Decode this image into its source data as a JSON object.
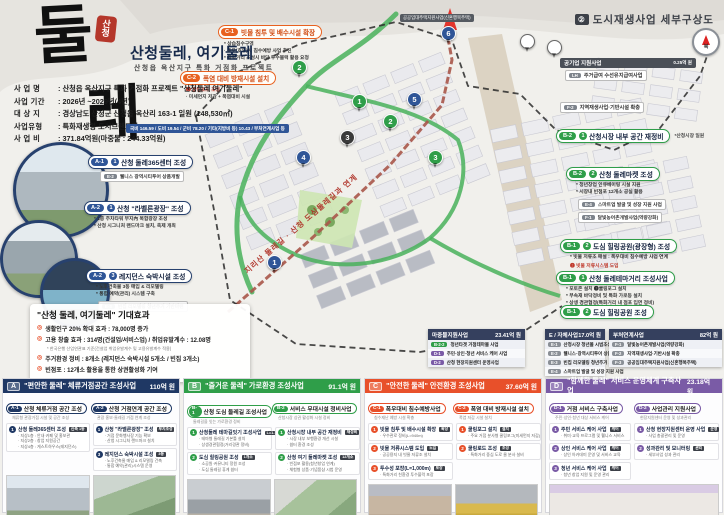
{
  "header": {
    "logo_char1": "둘",
    "logo_char2": "레",
    "stamp_line1": "산",
    "stamp_line2": "청",
    "title": "산청둘레, 여기둘레",
    "subtitle": "산청읍 옥산지구 특화 거점화 프로젝트"
  },
  "project_info": {
    "rows": [
      {
        "label": "사 업 명",
        "value": "산청읍 옥산지구 특화 거점화 프로젝트 \"산청둘레 여기둘레\""
      },
      {
        "label": "사업 기간",
        "value": "2026년 ~2029년(4년)"
      },
      {
        "label": "대 상 지",
        "value": "경상남도 산청군 산청읍 옥산리 163-1 일원 (148,530㎡)"
      },
      {
        "label": "사업유형",
        "value": "특화재생형 도시브랜드화"
      },
      {
        "label": "사 업 비",
        "value": "371.84억원(마중물 : 244.33억원)"
      }
    ],
    "funding_bar": "국비 146.59 / 도비 19.54 / 군비 78.20 / 기타(지방비 등) 10.43 / 부처연계사업 등"
  },
  "left_callouts": [
    {
      "code": "A-1",
      "num": "①",
      "title": "산청 둘레365센터 조성",
      "bullets": [],
      "boxes": [
        {
          "code": "E-2",
          "text": "웰니스 광역시티투어 상품개발"
        }
      ],
      "x": 88,
      "y": 150
    },
    {
      "code": "A-2",
      "num": "①",
      "title": "산청 \"라벨른광장\" 조성",
      "bullets": [
        "* 1층 주차타워 부지內 복합광장 조성",
        "* 산청 시그니처 랜드마크 설치, 축제 개최"
      ],
      "boxes": [],
      "x": 84,
      "y": 196
    },
    {
      "code": "A-2",
      "num": "❸",
      "title": "레지던스 숙박시설 조성",
      "bullets": [
        "* 노후건축물 3동 매입 & 리모델링",
        "* 통합 예약(관리) 시스템 구축"
      ],
      "boxes": [
        {
          "code": "E-3",
          "text": "빈집 리모델링 청년주거 기반마련"
        }
      ],
      "x": 86,
      "y": 264
    }
  ],
  "effects": {
    "title": "\"산청 둘레, 여기둘레\" 기대효과",
    "items": [
      "생활인구 20% 확대 효과 : 78,000명 증가",
      "고용 창출 효과 : 314명(건설업/서비스업) / 취업유발계수 : 12.08명",
      "주거환경 정비 : 8개소 (레지던스 숙박시설 5개소 / 빈집 3개소)",
      "빈점포 : 12개소 활용을 통한 상권활성화 기여"
    ],
    "footnote": "* 한국은행 산업연관표 기준(건설업 취업유발계수 및 고용유발계수 적용)"
  },
  "map": {
    "title_num": "②",
    "title": "도시재생사업 세부구상도",
    "compass_label": "북",
    "corridor_label": "지리산 둘레길 · 산청 도심둘레길과 연계",
    "arrow_label": "공공임대주택지원사업(신혼행복주택)",
    "callout_c1": {
      "code": "C-1",
      "title": "빗물 침투 및 배수시설 확장",
      "bullets": [
        "* 상습침수구역",
        "· 폭우(호우)시 침수예방 사업 추진",
        "* 특화거리 조성시 바닥 투수블럭 활용 요청"
      ]
    },
    "callout_c2": {
      "code": "C-2",
      "title": "폭염 대비 방재시설 설치",
      "bullets": [
        "❷ 쿨링로드 조성",
        "· 미세먼지 저감 + 폭염대비 시설"
      ]
    },
    "public_support": {
      "title": "공기업 지원사업",
      "amount": "0.25억 원",
      "row_code": "LH",
      "row_text": "주거급여 수선유지급여사업"
    },
    "f2_box": {
      "code": "F-2",
      "text": "지역재생사업·기반시설 확충"
    },
    "right_callouts": [
      {
        "code": "B-2",
        "num": "①",
        "title": "산청시장 내부 공간 재정비",
        "side": "*산청시장 일원",
        "bullets": [],
        "boxes": [],
        "red": "",
        "x": 556,
        "y": 124
      },
      {
        "code": "B-2",
        "num": "②",
        "title": "산청 둘레마켓 조성",
        "side": "",
        "bullets": [
          "* 청년창업 인큐베이팅 시설 지원",
          "* 시장내 빈점포 12개소 공실 활용"
        ],
        "boxes": [
          {
            "code": "E-4",
            "text": "스마트업 발굴 및 성장 지원 사업"
          },
          {
            "code": "F-1",
            "text": "달빛농어촌개발사업(역량강화)"
          }
        ],
        "red": "",
        "x": 566,
        "y": 162
      },
      {
        "code": "B-1",
        "num": "②",
        "title": "도심 힐링공원(광장형) 조성",
        "side": "",
        "bullets": [
          "* 빗물 저류조 매설 : 폭우대비 침수예방 사업 연계"
        ],
        "boxes": [],
        "red": "❷ 빗물 저류시스템 도입",
        "x": 560,
        "y": 234
      },
      {
        "code": "B-1",
        "num": "①",
        "title": "산청 둘레테마거리 조성사업",
        "side": "",
        "bullets": [
          "* 포토존 설치  ❶쿨링포그 설치",
          "* 부속재 바닥정비 및 특화 가로등 설치",
          "* 상생 경관협정(특화거리 내 점포 입면 정비)"
        ],
        "boxes": [],
        "red": "",
        "x": 556,
        "y": 266
      },
      {
        "code": "B-1",
        "num": "②",
        "title": "도심 힐링공원 조성",
        "side": "",
        "bullets": [],
        "boxes": [],
        "red": "",
        "x": 560,
        "y": 300
      }
    ],
    "pins": [
      {
        "n": "6",
        "c": "#2f5597",
        "x": 441,
        "y": 26
      },
      {
        "n": "2",
        "c": "#2f9e49",
        "x": 292,
        "y": 60
      },
      {
        "n": "1",
        "c": "#2f9e49",
        "x": 352,
        "y": 94
      },
      {
        "n": "5",
        "c": "#2f5597",
        "x": 407,
        "y": 92
      },
      {
        "n": "2",
        "c": "#2f9e49",
        "x": 383,
        "y": 114
      },
      {
        "n": "3",
        "c": "#3a3a3a",
        "x": 340,
        "y": 130
      },
      {
        "n": "4",
        "c": "#2f5597",
        "x": 296,
        "y": 150
      },
      {
        "n": "3",
        "c": "#2f9e49",
        "x": 428,
        "y": 150
      },
      {
        "n": "1",
        "c": "#2f5597",
        "x": 267,
        "y": 255
      },
      {
        "n": "",
        "c": "#ffffff",
        "x": 520,
        "y": 34
      },
      {
        "n": "",
        "c": "#ffffff",
        "x": 547,
        "y": 40
      }
    ]
  },
  "fund_tables": [
    {
      "title": "마중물지원사업",
      "amount": "23.41억 원",
      "x": 428,
      "y": 329,
      "w": 97,
      "rows": [
        {
          "code": "B-2-2",
          "color": "green",
          "text": "청년타겟 거점테마몰 사업"
        },
        {
          "code": "D-1",
          "color": "purple",
          "text": "주민·상인·청년 서비스 케어 사업"
        },
        {
          "code": "D-2",
          "color": "purple",
          "text": "산청 현장지원센터 운영사업"
        }
      ]
    },
    {
      "title": "E / 자체사업",
      "amount": "17.0억 원",
      "x": 545,
      "y": 329,
      "w": 60,
      "rows": [
        {
          "code": "E-1",
          "color": "gray",
          "text": "산청시장 청년몰 시범조성사업"
        },
        {
          "code": "E-2",
          "color": "gray",
          "text": "웰니스·광역시티투어 상품개발"
        },
        {
          "code": "E-3",
          "color": "gray",
          "text": "빈집 리모델링 청년주거 기반마련"
        },
        {
          "code": "E-4",
          "color": "gray",
          "text": "스마트업 발굴 및 성장 지원 사업"
        }
      ]
    },
    {
      "title": "부처연계사업",
      "amount": "82억 원",
      "x": 609,
      "y": 329,
      "w": 113,
      "rows": [
        {
          "code": "F-1",
          "color": "gray",
          "text": "달빛농어촌개발사업(역량강화)"
        },
        {
          "code": "F-2",
          "color": "gray",
          "text": "지역재생사업·기반시설 확충"
        },
        {
          "code": "F-3",
          "color": "gray",
          "text": "공공임대주택지원사업(신혼행복주택)"
        }
      ]
    }
  ],
  "panels": [
    {
      "letter": "A",
      "color": "#1f3864",
      "title": "\"편안한 둘레\" 체류거점공간 조성사업",
      "amount": "110억 원",
      "x": 2,
      "groups": [
        {
          "code": "A-1",
          "title": "산청 체류거점 공간 조성",
          "note": "체류형 관광거점 시설 및 공간 조성"
        },
        {
          "code": "A-2",
          "title": "산청 거점연계 공간 조성",
          "note": "관광 홍보·둘레길 거점 연계 조성"
        }
      ],
      "items": [
        {
          "col": 0,
          "num": "①",
          "title": "산청 둘레365센터 조성",
          "tag": "신축 1동",
          "bullets": [
            "· 지상1층 : 안내·카페 및 홍보관",
            "· 지상2층 : 창업 지원공간",
            "· 지상4층 : 게스트하우스(레지던스)"
          ]
        },
        {
          "col": 1,
          "num": "①",
          "title": "산청 \"라벨른광장\" 조성",
          "tag": "부지조성",
          "bullets": [
            "· 거점 문화행사장 기능 확보",
            "· 산청 시그니처 랜드마크 설치"
          ]
        },
        {
          "col": 1,
          "num": "❸",
          "title": "레지던스 숙박시설 조성",
          "tag": "3동",
          "bullets": [
            "· 노후건축물 매입 & 리모델링 건축",
            "· 통합 예약(관리)시스템 운영"
          ]
        }
      ],
      "photos": [
        "ph-a1",
        "ph-a2"
      ]
    },
    {
      "letter": "B",
      "color": "#2f9e49",
      "title": "\"즐거운 둘레\" 가로환경 조성사업",
      "amount": "91.1억 원",
      "x": 183,
      "groups": [
        {
          "code": "B-1",
          "title": "산청 도심 둘레길 조성사업",
          "note": "둘레길을 잇는 가로환경 정비"
        },
        {
          "code": "B-2",
          "title": "서비스 무대시설 정비사업",
          "note": "산청시장 상권 활성화 시설 정비"
        }
      ],
      "items": [
        {
          "col": 0,
          "num": "①",
          "title": "산청둘레 테마길잇기 조성사업",
          "tag": "L=1.1km",
          "bullets": [
            "· 테마형 둘레길 기본틀 설치",
            "· 상생경관협정(거리경관 정비)"
          ]
        },
        {
          "col": 0,
          "num": "②",
          "title": "도심 힐링공원 조성",
          "tag": "1개소",
          "bullets": [
            "· 소공원·커뮤니티 정원 조성",
            "· 도심 둘레길 휴게 쉼터"
          ]
        },
        {
          "col": 1,
          "num": "①",
          "title": "산청시장 내부 공간 재정비",
          "tag": "재정비",
          "bullets": [
            "· 시장 내부 보행환경 개선 시설",
            "· 쉼터 환경 조성"
          ]
        },
        {
          "col": 1,
          "num": "②",
          "title": "산청 여기 둘레마켓 조성",
          "tag": "12개소",
          "bullets": [
            "· 빈점포 활용(청년창업 연계)",
            "· 체험형 상품·기념품샵 시범 운영"
          ]
        }
      ],
      "photos": [
        "ph-b1",
        "ph-b2"
      ]
    },
    {
      "letter": "C",
      "color": "#e8502a",
      "title": "\"안전한 둘레\" 안전환경 조성사업",
      "amount": "37.60억 원",
      "x": 364,
      "groups": [
        {
          "code": "C-1",
          "title": "폭우대비 침수예방사업",
          "note": "침수재난 예방 시설 확충"
        },
        {
          "code": "C-2",
          "title": "폭염 대비 방재시설 설치",
          "note": "폭염 저감 시설 설치"
        }
      ],
      "items": [
        {
          "col": 0,
          "num": "①",
          "title": "빗물 침투 및 배수시설 확장",
          "tag": "확장",
          "bullets": [
            "· 우수관로 정비(L=940m)"
          ]
        },
        {
          "col": 0,
          "num": "②",
          "title": "빗물 저류시스템 도입",
          "tag": "도입",
          "bullets": [
            "· 공공용지 내 빗물 저류조 설치"
          ]
        },
        {
          "col": 0,
          "num": "③",
          "title": "투수성 포장(L=1,000m)",
          "tag": "포장",
          "bullets": [
            "· 특화거리 친환경 투수블럭 포장"
          ]
        },
        {
          "col": 1,
          "num": "①",
          "title": "쿨링포그 설치",
          "tag": "설치",
          "bullets": [
            "· 주요 거점 분사형 쿨링포그(미세먼지 저감)"
          ]
        },
        {
          "col": 1,
          "num": "②",
          "title": "쿨링로드 조성",
          "tag": "조성",
          "bullets": [
            "· 특화거리 중심 도로 물 분사 설비"
          ]
        }
      ],
      "photos": [
        "ph-c1",
        "ph-c2"
      ]
    },
    {
      "letter": "D",
      "color": "#7a5ba6",
      "title": "\"함께한 둘레\" 서비스 운영체계 구축사업",
      "amount": "23.18억 원",
      "x": 545,
      "groups": [
        {
          "code": "D-1",
          "title": "거점 서비스 구축사업",
          "note": "주민·상인·청년 대상 서비스 케어"
        },
        {
          "code": "D-2",
          "title": "사업관리 지원사업",
          "note": "현장지원센터 운영 및 성과관리"
        }
      ],
      "items": [
        {
          "col": 0,
          "num": "①",
          "title": "주민 서비스 케어 사업",
          "tag": "케어",
          "bullets": [
            "· 취미·교육 프로그램 및 웰니스 서비스"
          ]
        },
        {
          "col": 0,
          "num": "②",
          "title": "상인 서비스 케어 사업",
          "tag": "케어",
          "bullets": [
            "· 상인 아카데미 운영 및 서비스 교육"
          ]
        },
        {
          "col": 0,
          "num": "③",
          "title": "청년 서비스 케어 사업",
          "tag": "케어",
          "bullets": [
            "· 청년 창업 지원 및 운영 관리"
          ]
        },
        {
          "col": 1,
          "num": "①",
          "title": "산청 현장지원센터 운영 사업",
          "tag": "운영",
          "bullets": [
            "· 사업 총괄관리 및 운영"
          ]
        },
        {
          "col": 1,
          "num": "②",
          "title": "성과관리 및 모니터링",
          "tag": "관리",
          "bullets": [
            "· 세부사업 성과 관리"
          ]
        }
      ],
      "photos": [
        "ph-d1"
      ]
    }
  ]
}
